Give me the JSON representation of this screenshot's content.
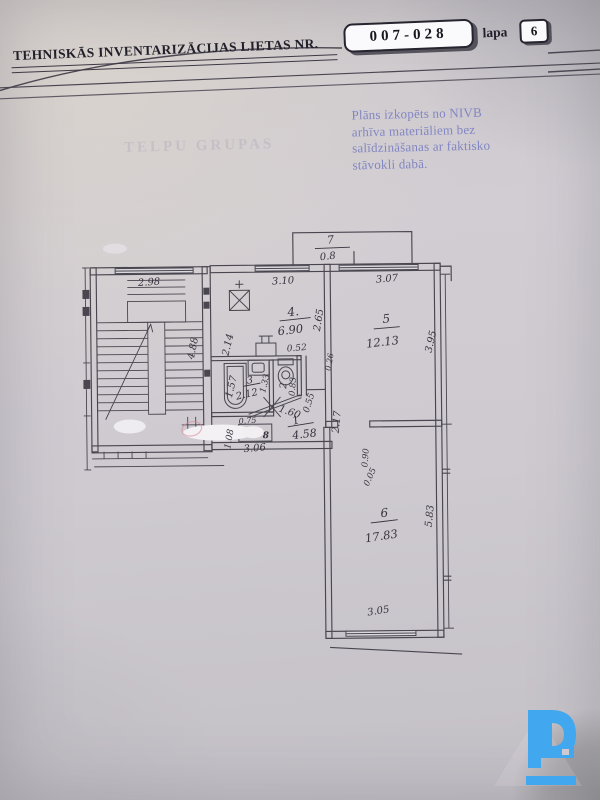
{
  "header": {
    "title": "TEHNISKĀS INVENTARIZĀCIJAS LIETAS NR.",
    "case_number": "007-028",
    "page_label": "lapa",
    "page_number": "6"
  },
  "stamp": {
    "line1": "Plāns izkopēts no NIVB",
    "line2": "arhīva materiāliem bez",
    "line3": "salīdzināšanas ar faktisko",
    "line4": "stāvokli dabā."
  },
  "ghost_text": "TELPU GRUPAS",
  "plan": {
    "rooms": {
      "balcony": {
        "no": "7",
        "area": "0.8"
      },
      "kitchen": {
        "no": "4.",
        "area": "6.90"
      },
      "bathroom": {
        "no": "3",
        "area": "2.12"
      },
      "wc": {
        "no": "2",
        "area": "0.83"
      },
      "hall": {
        "no": "1",
        "area": "4.58"
      },
      "room5": {
        "no": "5",
        "area": "12.13"
      },
      "room6": {
        "no": "6",
        "area": "17.83"
      }
    },
    "dims": {
      "stairs_width": "2.98",
      "stairs_height": "4.88",
      "kitchen_width": "3.10",
      "kitchen_left": "2.14",
      "kitchen_right": "2.65",
      "sink": "0.52",
      "niche": "0.26",
      "tub": "1.57",
      "bath_height": "1.33",
      "door": "1.60",
      "wc_side": "0.55",
      "hall_right": "2.17",
      "cupboard": "0.75",
      "hall_left": "1.08",
      "hall_width": "3.06",
      "room5_width": "3.07",
      "room5_height": "3.95",
      "room6_height": "5.83",
      "room6_width": "3.05",
      "door6": "0.90",
      "gap": "0.05"
    },
    "marks": {
      "cupboard_glyph": "8"
    }
  },
  "watermark": {
    "icon": "d-logo",
    "color": "#41a7ef"
  },
  "colors": {
    "stamp": "#7b80c2",
    "ink": "#4a4650",
    "paper": "#cecad0",
    "redmark": "#d88b97"
  }
}
